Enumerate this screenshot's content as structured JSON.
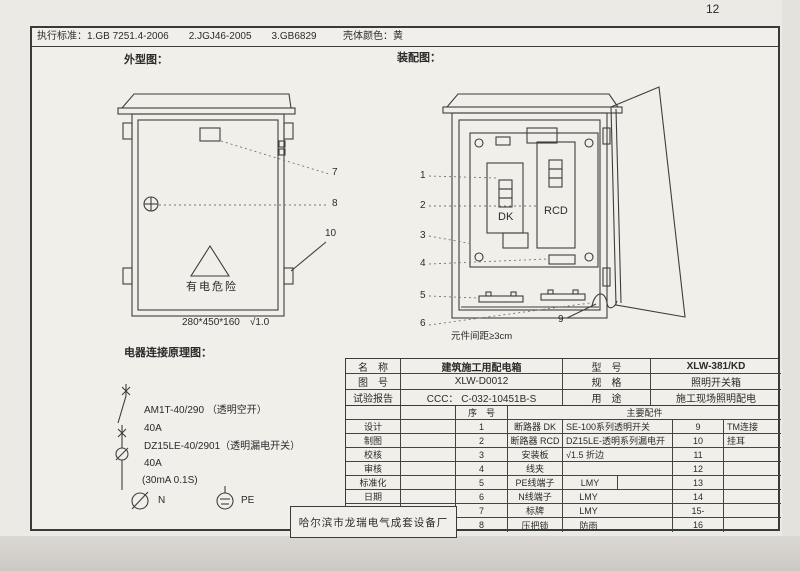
{
  "page": {
    "number": "12"
  },
  "header": {
    "standards": "执行标准：1.GB 7251.4-2006　　2.JGJ46-2005　　3.GB6829",
    "shell_color": "壳体颜色：黄"
  },
  "exterior": {
    "title": "外型图：",
    "warning": "有电危险",
    "dimension": "280*450*160　√1.0",
    "callouts": {
      "c7": "7",
      "c8": "8",
      "c10": "10"
    }
  },
  "assembly": {
    "title": "装配图：",
    "dk_label": "DK",
    "rcd_label": "RCD",
    "note": "元件间距≥3cm",
    "callouts": {
      "c1": "1",
      "c2": "2",
      "c3": "3",
      "c4": "4",
      "c5": "5",
      "c6": "6",
      "c9": "9"
    }
  },
  "schematic": {
    "title": "电器连接原理图：",
    "line1": "AM1T-40/290 （透明空开）",
    "line2": "40A",
    "line3": "DZ15LE-40/2901（透明漏电开关）",
    "line4": "40A",
    "line5": "(30mA 0.1S)",
    "n_label": "N",
    "pe_label": "PE"
  },
  "table": {
    "info": [
      {
        "l1": "名　称",
        "v1": "建筑施工用配电箱",
        "l2": "型　号",
        "v2": "XLW-381/KD"
      },
      {
        "l1": "图　号",
        "v1": "XLW-D0012",
        "l2": "规　格",
        "v2": "照明开关箱"
      },
      {
        "l1": "试验报告",
        "v1": "CCC： C-032-10451B-S",
        "l2": "用　途",
        "v2": "施工现场照明配电"
      }
    ],
    "seq_header": "序　号",
    "parts_header": "主要配件",
    "sign_labels": [
      "设计",
      "制图",
      "校核",
      "审核",
      "标准化",
      "日期"
    ],
    "rows": [
      {
        "no": "1",
        "name": "断路器 DK",
        "desc": "SE-100系列透明开关",
        "no2": "9",
        "desc2": "TM连接"
      },
      {
        "no": "2",
        "name": "断路器 RCD",
        "desc": "DZ15LE-透明系列漏电开",
        "no2": "10",
        "desc2": "挂耳"
      },
      {
        "no": "3",
        "name": "安装板",
        "desc": "√1.5 折边",
        "no2": "11",
        "desc2": ""
      },
      {
        "no": "4",
        "name": "线夹",
        "desc": "",
        "no2": "12",
        "desc2": ""
      },
      {
        "no": "5",
        "name": "PE线端子",
        "desc": "LMY",
        "no2": "13",
        "desc2": ""
      },
      {
        "no": "6",
        "name": "N线端子",
        "desc": "LMY",
        "no2": "14",
        "desc2": ""
      },
      {
        "no": "7",
        "name": "标牌",
        "desc": "LMY",
        "no2": "15-",
        "desc2": ""
      },
      {
        "no": "8",
        "name": "压把锁",
        "desc": "防雨",
        "no2": "16",
        "desc2": ""
      }
    ]
  },
  "factory": {
    "name": "哈尔滨市龙瑞电气成套设备厂"
  }
}
